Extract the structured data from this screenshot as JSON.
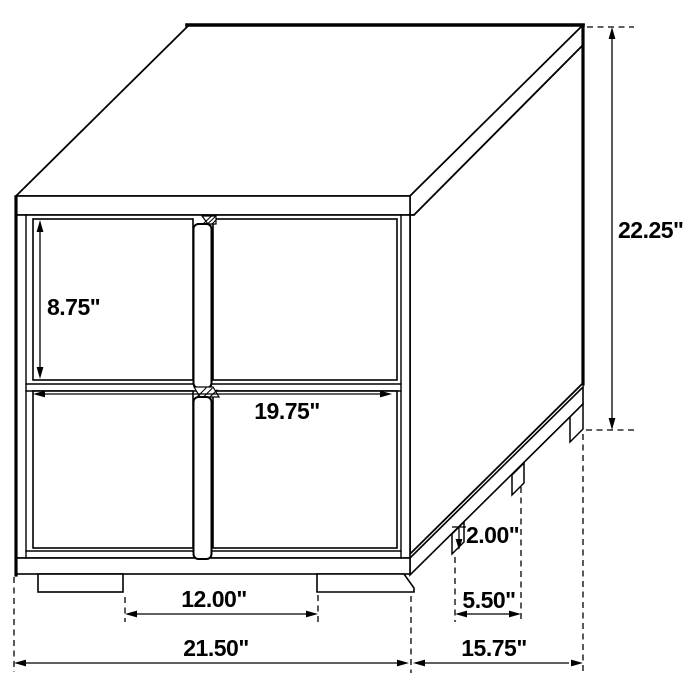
{
  "page": {
    "background": "#ffffff",
    "line_color": "#000000"
  },
  "diagram": {
    "title": "Two-drawer nightstand dimension drawing",
    "object": "nightstand with four square drawer panels and center bar handles",
    "dimensions": {
      "overall_height": "22.25\"",
      "top_drawer_height": "8.75\"",
      "drawer_width": "19.75\"",
      "front_feet_spacing": "12.00\"",
      "overall_width": "21.50\"",
      "overall_depth": "15.75\"",
      "base_height": "2.00\"",
      "side_feet_spacing": "5.50\""
    }
  }
}
